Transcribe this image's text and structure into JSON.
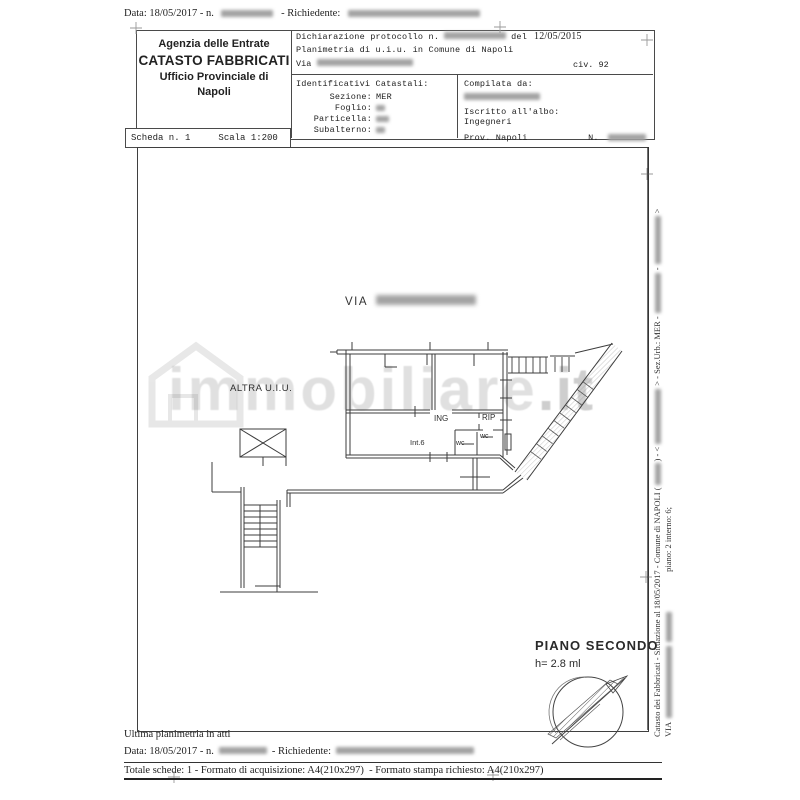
{
  "doc": {
    "top_bar": {
      "data_prefix": "Data: 18/05/2017 - n.",
      "richiedente_label": "- Richiedente:"
    },
    "header": {
      "office_box": {
        "line1": "Agenzia delle Entrate",
        "line2": "CATASTO FABBRICATI",
        "line3": "Ufficio Provinciale di",
        "line4": "Napoli"
      },
      "scheda_box": {
        "scheda": "Scheda n. 1",
        "scala": "Scala 1:200"
      },
      "declaration": {
        "protocollo": "Dichiarazione protocollo n.",
        "del": "del",
        "date": "12/05/2015",
        "planimetria": "Planimetria di u.i.u. in Comune di Napoli",
        "via": "Via",
        "civ": "civ. 92"
      },
      "identificativi": {
        "title": "Identificativi Catastali:",
        "sezione_label": "Sezione:",
        "sezione_value": "MER",
        "foglio_label": "Foglio:",
        "particella_label": "Particella:",
        "subalterno_label": "Subalterno:"
      },
      "compilata": {
        "compilata_label": "Compilata da:",
        "iscritto_label": "Iscritto all'albo:",
        "iscritto_value": "Ingegneri",
        "prov": "Prov. Napoli",
        "n_label": "N."
      }
    },
    "plan": {
      "via_label": "VIA",
      "altra_uiu": "ALTRA U.I.U.",
      "room_ing": "ING",
      "room_rip": "RIP",
      "room_wc1": "wc",
      "room_wc2": "wc",
      "room_int": "Int.6",
      "piano_title": "PIANO SECONDO",
      "piano_height": "h= 2.8 ml",
      "watermark_text": "immobiliare",
      "watermark_tld": ".it"
    },
    "side_text": {
      "seg1": "Catasto dei Fabbricati - Situazione al 18/05/2017 - Comune di NAPOLI (",
      "seg2": ") - <",
      "seg3": "> - Sez.Urb.: MER -",
      "seg4": "-",
      "seg5": ">",
      "line2_via": "VIA",
      "line2_piano": "piano: 2 interno: 6;"
    },
    "footer": {
      "ultima": "Ultima planimetria in atti",
      "data_prefix": "Data: 18/05/2017 - n.",
      "richiedente_label": "- Richiedente:",
      "totale": "Totale schede: 1 - Formato di acquisizione: A4(210x297)  - Formato stampa richiesto: A4(210x297)"
    },
    "colors": {
      "line": "#4a4a4a",
      "redact": "#a3a3a3",
      "watermark_gray": "#7d7d7d"
    }
  }
}
